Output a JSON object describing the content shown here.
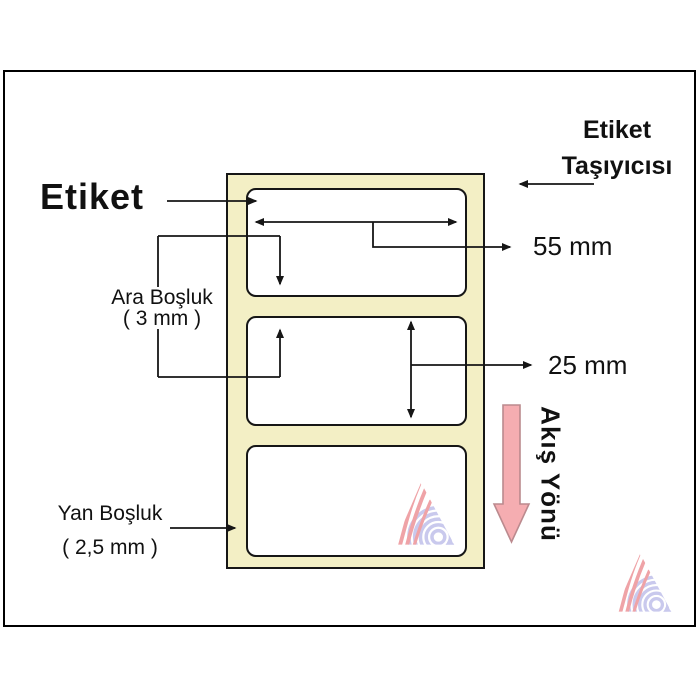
{
  "diagram": {
    "heading": "Etiket",
    "carrier_label": {
      "line1": "Etiket",
      "line2": "Taşıyıcısı"
    },
    "width_dim": "55 mm",
    "height_dim": "25 mm",
    "gap_label": {
      "line1": "Ara Boşluk",
      "line2": "( 3 mm )"
    },
    "side_label": {
      "line1": "Yan Boşluk",
      "line2": "( 2,5 mm )"
    },
    "flow_label": "Akış Yönü",
    "blank_label_count": 3
  },
  "icons": {
    "flow_arrow": "flow-direction-down-arrow",
    "watermark": "wavy-triangle-logo-watermark",
    "dimension_arrows": "black-measurement-arrows"
  },
  "colors": {
    "background": "#ffffff",
    "page_border": "#000000",
    "outline": "#161616",
    "carrier_fill": "#f3efc5",
    "flow_arrow_fill": "#f5adb1",
    "flow_arrow_stroke": "#bb8a8e",
    "watermark_pink": "#efa3a7",
    "watermark_lavender": "#c9c9ed"
  }
}
